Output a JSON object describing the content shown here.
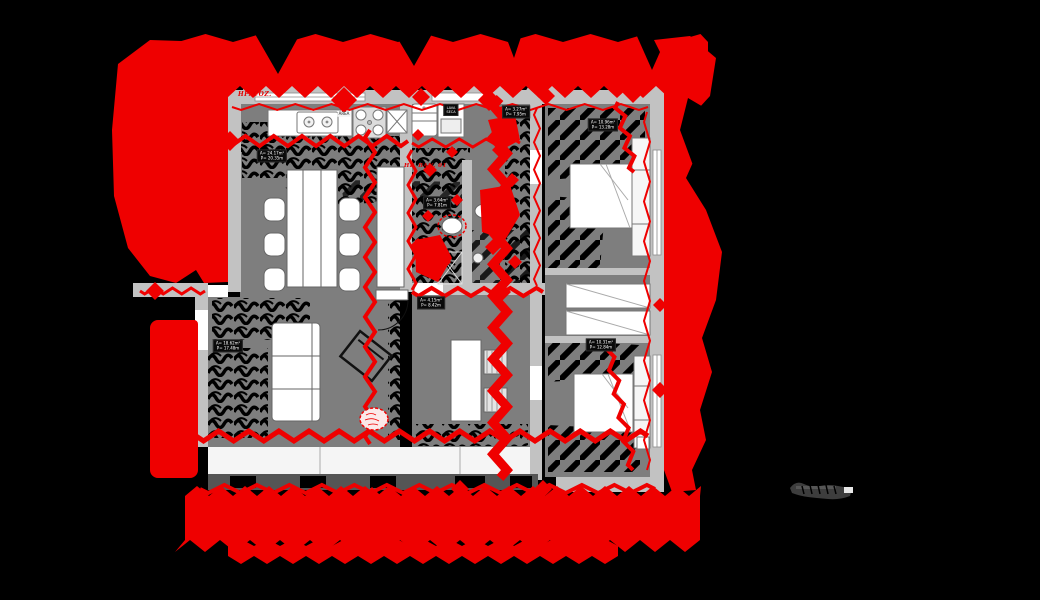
{
  "scene": {
    "title": "apartment-floor-plan-with-red-markup",
    "colors": {
      "background": "#000000",
      "markup_red": "#ef0000",
      "wall_gray": "#c2c2c2",
      "floor_gray": "#7e7e7e",
      "fixture_white": "#ffffff",
      "railing_dark": "#555555",
      "scale_glyph": "#3d3d3d"
    }
  },
  "annotations": {
    "hp_coz": "HP. COZ.",
    "hp_ban01": "HP. BAN. 01",
    "area_tag": "ÁREA"
  },
  "room_labels": [
    {
      "id": "dining",
      "line1": "A= 24.17m²",
      "line2": "P= 20.35m"
    },
    {
      "id": "living",
      "line1": "A= 18.62m²",
      "line2": "P= 17.48m"
    },
    {
      "id": "hall",
      "line1": "A= 3.27m²",
      "line2": "P= 7.95m"
    },
    {
      "id": "bath",
      "line1": "A= 3.64m²",
      "line2": "P= 7.81m"
    },
    {
      "id": "service",
      "line1": "A= 4.15m²",
      "line2": "P= 8.42m"
    },
    {
      "id": "bedroom-1",
      "line1": "A= 10.96m²",
      "line2": "P= 13.28m"
    },
    {
      "id": "bedroom-2",
      "line1": "A= 10.31m²",
      "line2": "P= 12.84m"
    },
    {
      "id": "washer",
      "line1": "LAVA",
      "line2": "SECA"
    }
  ]
}
